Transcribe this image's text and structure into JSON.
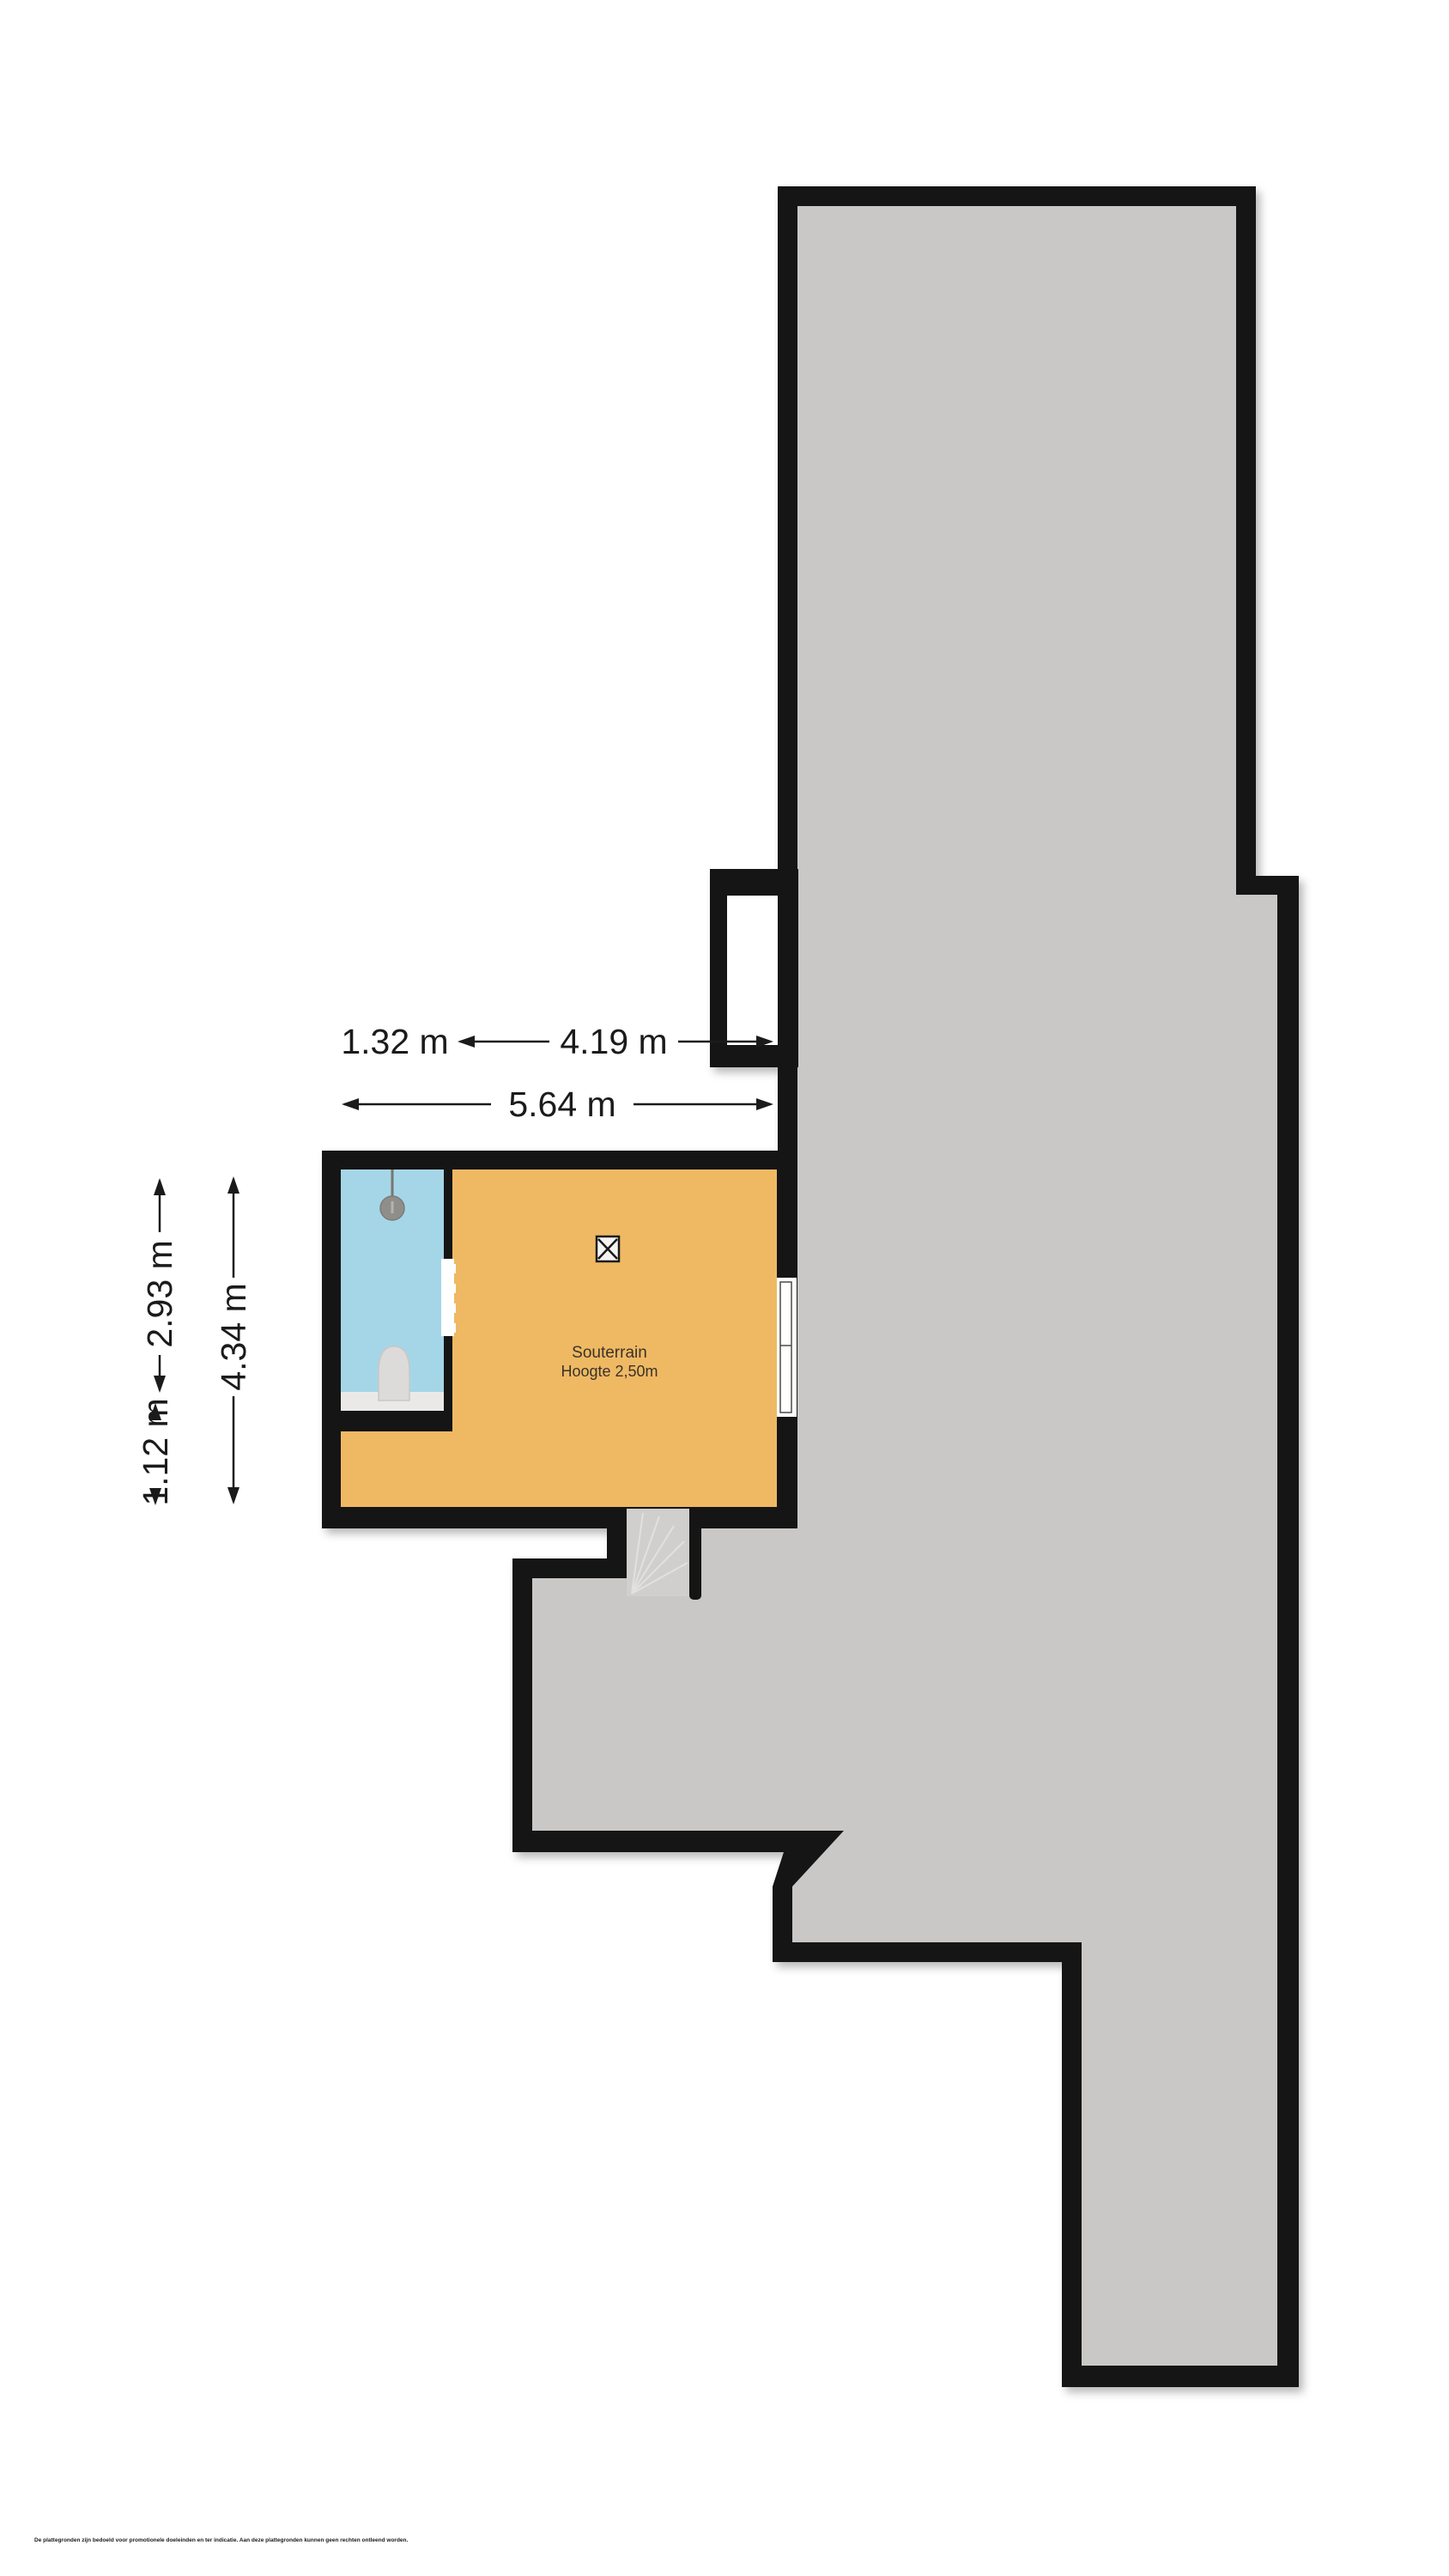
{
  "floorplan": {
    "room": {
      "name": "Souterrain",
      "height_label": "Hoogte 2,50m"
    },
    "dimensions": {
      "width_total": "5.64 m",
      "width_left": "1.32 m",
      "width_right": "4.19 m",
      "height_total": "4.34 m",
      "height_upper": "2.93 m",
      "height_lower": "1.12 m"
    },
    "colors": {
      "walls": "#151515",
      "footprint_fill": "#c9c8c6",
      "room_floor": "#efb964",
      "bathroom_floor": "#a5d6e7",
      "stairs_fill": "#d0cfcd",
      "fixture_fill": "#dddbd9",
      "counter_fill": "#eae9e7"
    },
    "icons": [
      "shower-icon",
      "toilet-icon",
      "ventilation-x-icon",
      "window",
      "door-opening",
      "stairs"
    ]
  },
  "footer": {
    "disclaimer": "De plattegronden zijn bedoeld voor promotionele doeleinden en ter indicatie. Aan deze plattegronden kunnen geen rechten ontleend worden."
  }
}
